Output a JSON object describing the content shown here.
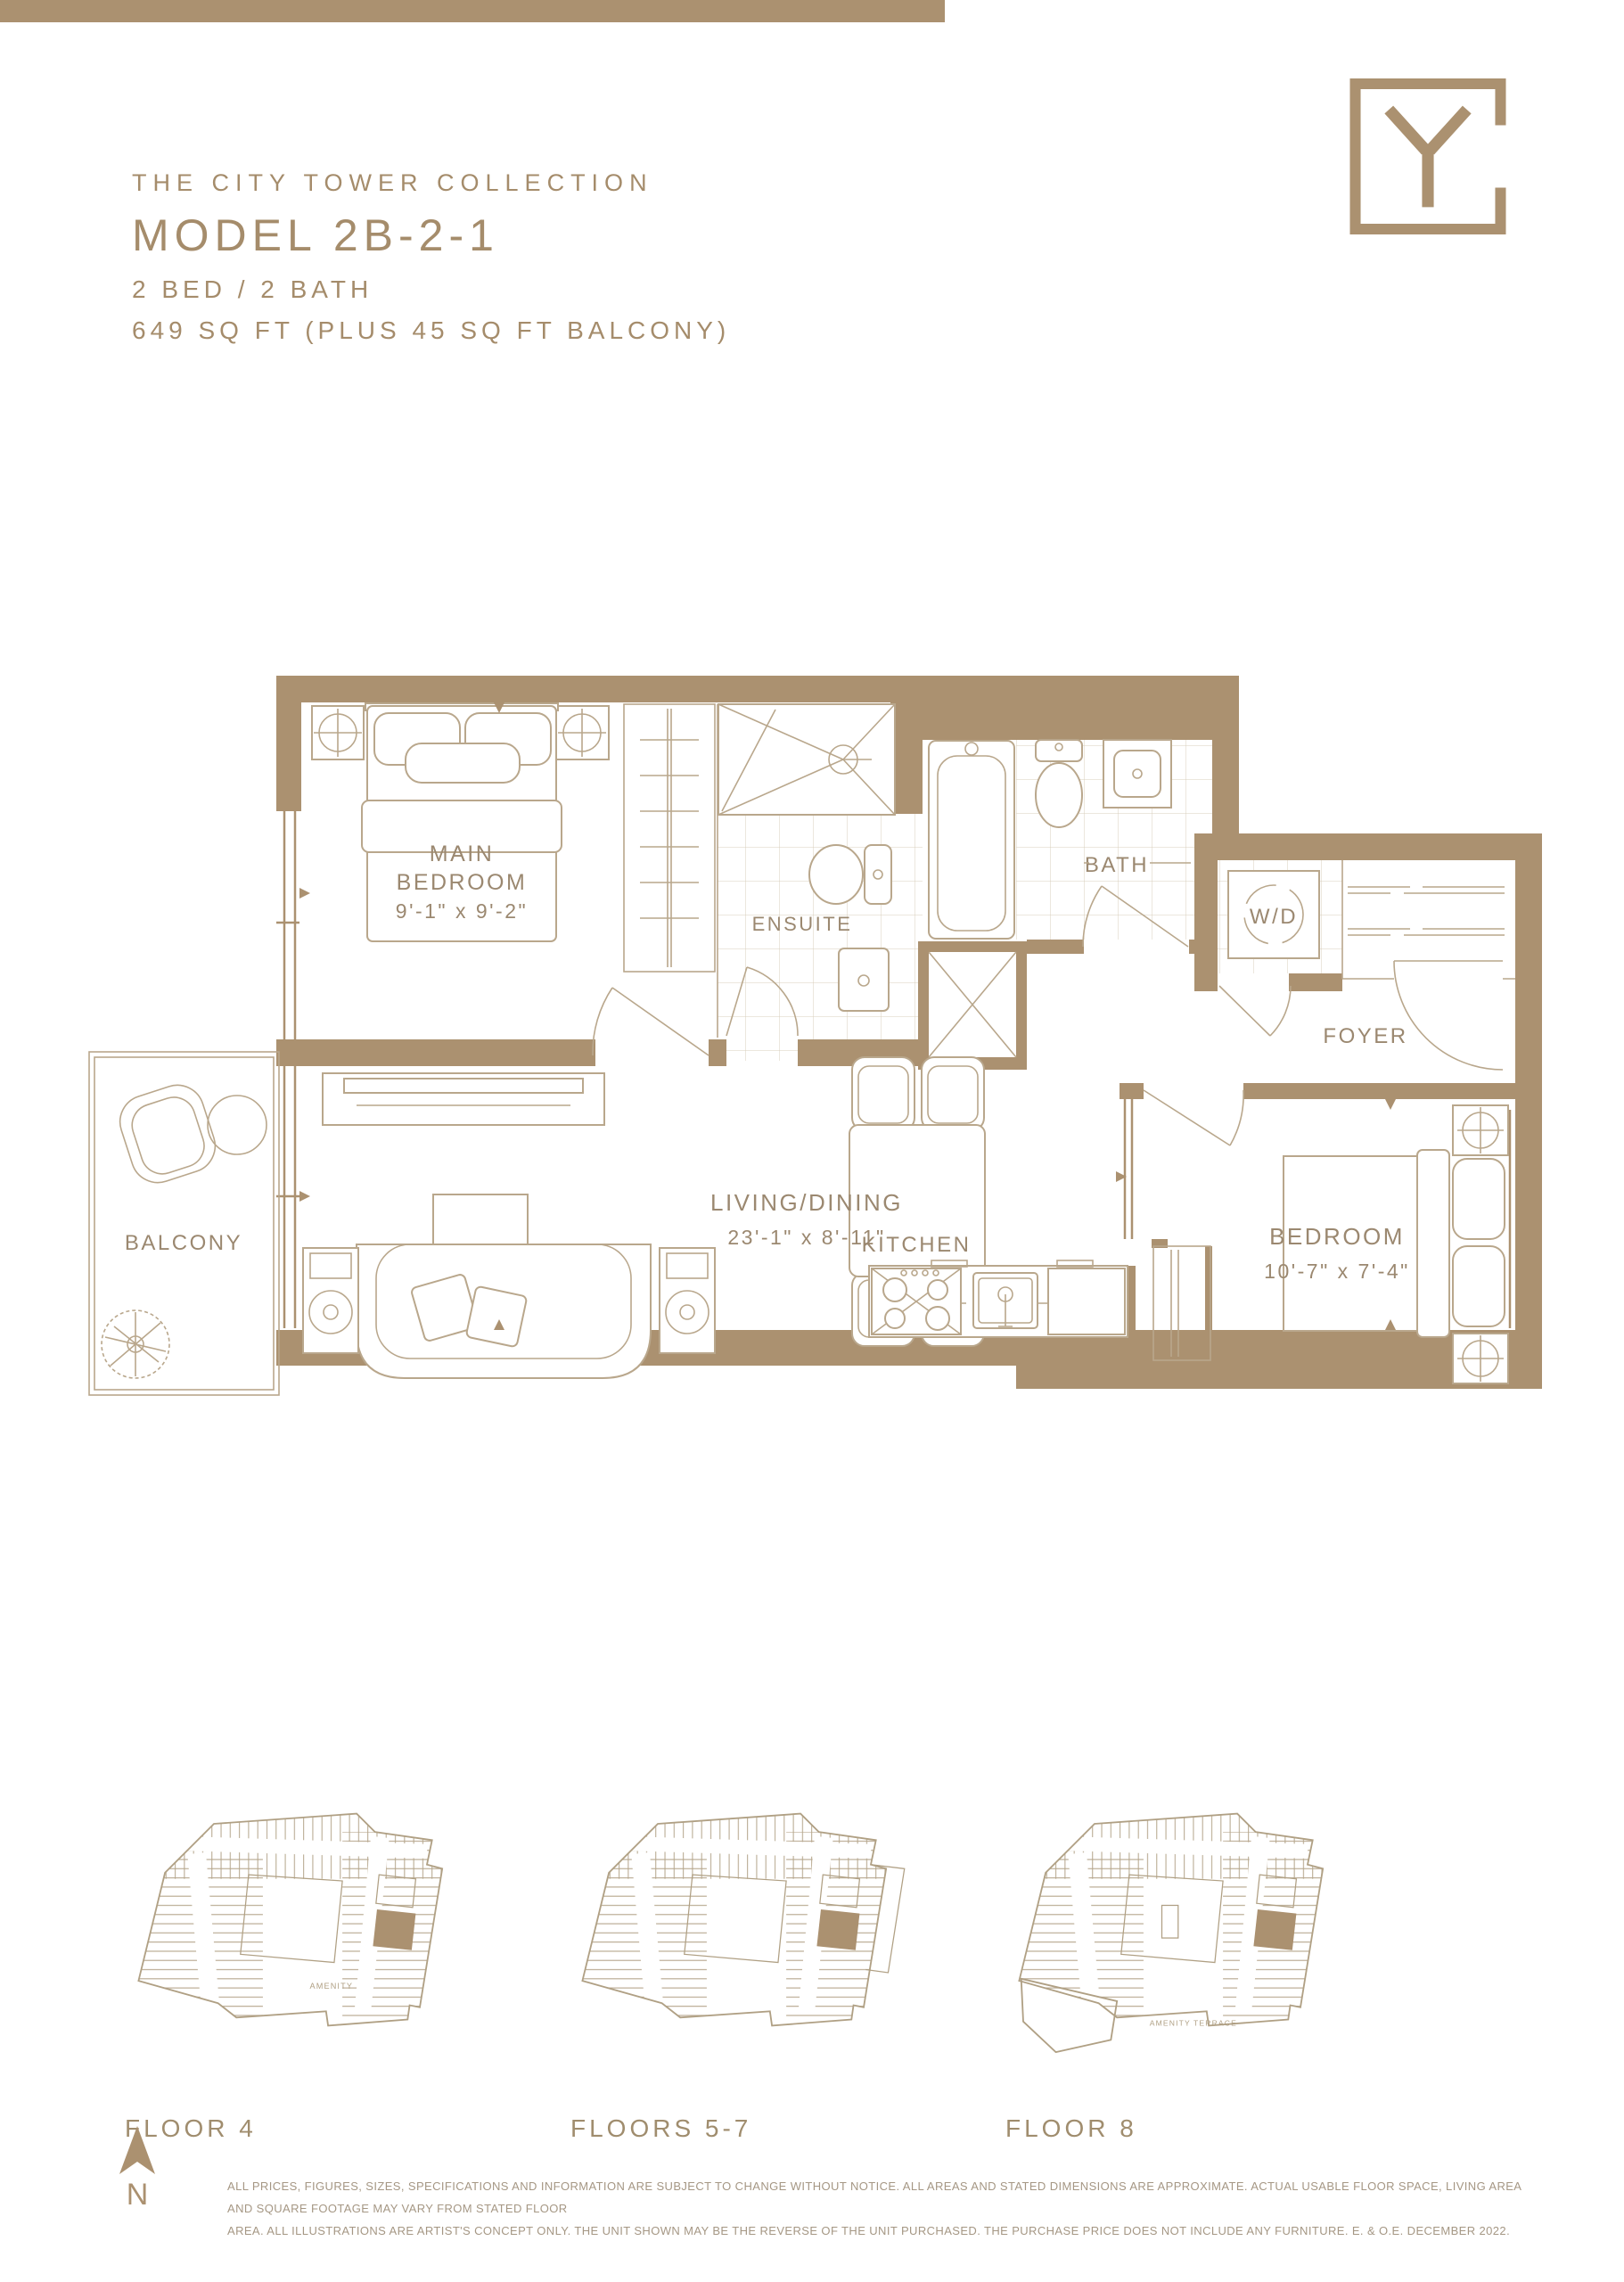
{
  "header": {
    "collection": "THE CITY TOWER COLLECTION",
    "model": "MODEL 2B-2-1",
    "bed_bath": "2 BED / 2 BATH",
    "area": "649 SQ FT (PLUS 45 SQ FT BALCONY)"
  },
  "floorplan": {
    "rooms": {
      "main_bedroom": {
        "line1": "MAIN",
        "line2": "BEDROOM",
        "dims": "9'-1\" x 9'-2\""
      },
      "ensuite": {
        "label": "ENSUITE"
      },
      "bath": {
        "label": "BATH"
      },
      "wd": {
        "label": "W/D"
      },
      "foyer": {
        "label": "FOYER"
      },
      "living_dining": {
        "line1": "LIVING/DINING",
        "dims": "23'-1\" x 8'-11\""
      },
      "kitchen": {
        "label": "KITCHEN"
      },
      "bedroom2": {
        "line1": "BEDROOM",
        "dims": "10'-7\" x 7'-4\""
      },
      "balcony": {
        "label": "BALCONY"
      }
    }
  },
  "keyplans": [
    {
      "label": "FLOOR 4",
      "amenity": "AMENITY"
    },
    {
      "label": "FLOORS 5-7",
      "amenity": ""
    },
    {
      "label": "FLOOR 8",
      "amenity": "AMENITY TERRACE"
    }
  ],
  "compass": {
    "label": "N"
  },
  "footer": {
    "line1": "ALL PRICES, FIGURES, SIZES, SPECIFICATIONS AND INFORMATION ARE SUBJECT TO CHANGE WITHOUT NOTICE. ALL AREAS AND STATED DIMENSIONS ARE APPROXIMATE. ACTUAL USABLE FLOOR SPACE, LIVING AREA AND SQUARE FOOTAGE MAY VARY FROM STATED FLOOR",
    "line2": "AREA. ALL ILLUSTRATIONS ARE ARTIST'S CONCEPT ONLY. THE UNIT SHOWN MAY BE THE REVERSE OF THE UNIT PURCHASED. THE PURCHASE PRICE DOES NOT INCLUDE ANY FURNITURE. E. & O.E. DECEMBER 2022."
  },
  "colors": {
    "accent": "#ab9170",
    "heading": "#a58c6b",
    "line": "#b9a78c"
  }
}
